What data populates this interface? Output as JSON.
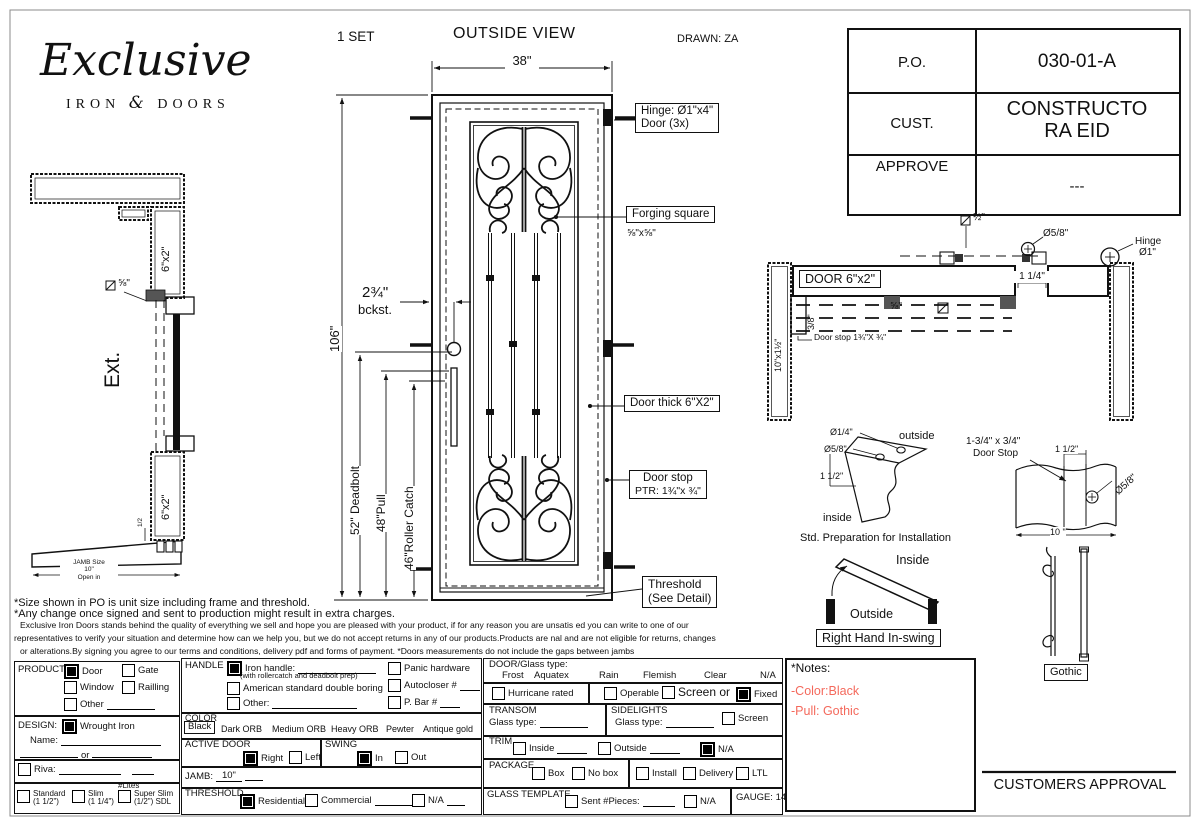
{
  "page": {
    "set": "1  SET",
    "view_title": "OUTSIDE VIEW",
    "drawn": "DRAWN: ZA"
  },
  "logo": {
    "script": "Exclusive",
    "word1": "IRON",
    "amp": "&",
    "word2": "DOORS"
  },
  "po_table": {
    "po_label": "P.O.",
    "po_value": "030-01-A",
    "cust_label": "CUST.",
    "cust_value": "CONSTRUCTO RA EID",
    "approve_label": "APPROVE",
    "approve_value": "---"
  },
  "elevation": {
    "dim_width": "38\"",
    "dim_height": "106\"",
    "dim_deadbolt": "52\" Deadbolt",
    "dim_pull": "48\"Pull",
    "dim_roller": "46\"Roller Catch",
    "backset1": "2¾\"",
    "backset2": "bckst.",
    "note_hinge1": "Hinge: Ø1\"x4\"",
    "note_hinge2": "Door (3x)",
    "note_forging": "Forging square",
    "note_forging_size": "⅝\"x⅝\"",
    "note_thick": "Door thick 6\"X2\"",
    "note_stop1": "Door stop",
    "note_stop2": "PTR: 1¾\"x ¾\"",
    "note_threshold1": "Threshold",
    "note_threshold2": "(See Detail)"
  },
  "left_section": {
    "ext": "Ext.",
    "tube_top": "6\"x2\"",
    "tube_bottom": "6\"x2\"",
    "dia_size": "⅝\"",
    "half": "1/2",
    "jamb1": "JAMB Size",
    "jamb2": "10\"",
    "jamb3": "Open in"
  },
  "plan": {
    "door": "DOOR 6\"x2\"",
    "jamb": "10\"x1½\"",
    "half_sq": "½\"",
    "dia58": "Ø5/8\"",
    "hinge1": "Hinge",
    "hinge2": "Ø1\"",
    "dim114": "1 1/4\"",
    "frac58": "⅝\"",
    "frac38": "3/8\"",
    "doorstop": "Door stop  1¾\"X ¾\""
  },
  "prep": {
    "d14": "Ø1/4\"",
    "d58": "Ø5/8\"",
    "d112": "1 1/2\"",
    "outside": "outside",
    "inside": "inside",
    "caption": "Std. Preparation for Installation"
  },
  "stop_detail": {
    "l1": "1-3/4\" x 3/4\"",
    "l2": "Door Stop",
    "d112": "1 1/2\"",
    "d58": "Ø5/8\"",
    "d10": "10 \""
  },
  "swing_detail": {
    "inside": "Inside",
    "outside": "Outside",
    "caption": "Right Hand In-swing"
  },
  "pull_detail": {
    "caption": "Gothic"
  },
  "disclaimer": {
    "l1": "*Size shown in PO is unit size including frame and threshold.",
    "l2": "*Any change once signed and sent to production might result in extra charges.",
    "l3": "Exclusive Iron Doors stands behind the quality of everything we sell and hope you are pleased with your product, if for any reason you are unsatis   ed you can write to one of our",
    "l4": "representatives to verify your situation and determine how can we help you, but we do not accept returns in any of our products.Products are    nal and are not eligible for returns, changes",
    "l5": "or alterations.By signing you agree to our terms and conditions, delivery pdf and forms of payment. *Doors measurements do not include the gaps between jambs"
  },
  "form": {
    "product": {
      "label": "PRODUCT:",
      "opt_door": "Door",
      "door_checked": true,
      "opt_gate": "Gate",
      "gate_checked": false,
      "opt_window": "Window",
      "window_checked": false,
      "opt_railling": "Railling",
      "railling_checked": false,
      "opt_other": "Other",
      "other_checked": false
    },
    "handle": {
      "label": "HANDLE",
      "iron": "Iron handle:",
      "iron_checked": true,
      "iron_note": "(with rollercatch and deadbolt prep)",
      "american": "American standard double boring",
      "american_checked": false,
      "other": "Other:",
      "other_checked": false,
      "panic": "Panic hardware",
      "panic_checked": false,
      "autocloser": "Autocloser #",
      "autocloser_checked": false,
      "pbar": "P. Bar #",
      "pbar_checked": false
    },
    "design": {
      "label": "DESIGN:",
      "wrought": "Wrought Iron",
      "wrought_checked": true,
      "name": "Name:",
      "or": "or"
    },
    "color": {
      "label": "COLOR",
      "selected": "Black",
      "opt2": "Dark ORB",
      "opt3": "Medium ORB",
      "opt4": "Heavy ORB",
      "opt5": "Pewter",
      "opt6": "Antique gold"
    },
    "active": {
      "label": "ACTIVE DOOR",
      "right": "Right",
      "right_checked": true,
      "left": "Left",
      "left_checked": false
    },
    "swing": {
      "label": "SWING",
      "in": "In",
      "in_checked": true,
      "out": "Out",
      "out_checked": false
    },
    "riva": {
      "label": "Riva:",
      "checked": false,
      "lites": "#Lites"
    },
    "grid": {
      "standard": "Standard",
      "standard_sub": "(1 1/2\")",
      "standard_checked": false,
      "slim": "Slim",
      "slim_sub": "(1 1/4\")",
      "slim_checked": false,
      "super": "Super Slim",
      "super_sub": "(1/2\") SDL",
      "super_checked": false
    },
    "jamb": {
      "label": "JAMB:",
      "value": "10\""
    },
    "threshold": {
      "label": "THRESHOLD",
      "residential": "Residential",
      "residential_checked": true,
      "commercial": "Commercial",
      "commercial_checked": false,
      "na": "N/A",
      "na_checked": false
    },
    "doorglass": {
      "label": "DOOR/Glass type:",
      "o1": "Frost",
      "o2": "Aquatex",
      "o3": "Rain",
      "o4": "Flemish",
      "o5": "Clear",
      "o6": "N/A"
    },
    "hurricane": {
      "label": "Hurricane rated",
      "checked": false
    },
    "screenrow": {
      "operable": "Operable",
      "operable_checked": false,
      "screen": "Screen or",
      "screen_checked": false,
      "fixed": "Fixed",
      "fixed_checked": true
    },
    "transom": {
      "label": "TRANSOM",
      "glass": "Glass type:"
    },
    "sidelights": {
      "label": "SIDELIGHTS",
      "glass": "Glass type:",
      "screen": "Screen",
      "screen_checked": false
    },
    "trim": {
      "label": "TRIM",
      "inside": "Inside",
      "inside_checked": false,
      "outside": "Outside",
      "outside_checked": false,
      "na": "N/A",
      "na_checked": true
    },
    "package": {
      "label": "PACKAGE",
      "box": "Box",
      "nobox": "No box",
      "install": "Install",
      "delivery": "Delivery",
      "ltl": "LTL"
    },
    "template": {
      "label": "GLASS TEMPLATE",
      "sent": "Sent #Pieces:",
      "sent_checked": false,
      "na": "N/A",
      "na_checked": false,
      "gauge": "GAUGE: 14"
    }
  },
  "notes": {
    "title": "*Notes:",
    "n1": "-Color:Black",
    "n2": "-Pull: Gothic",
    "color": "#f4695c"
  },
  "approval": {
    "label": "CUSTOMERS APPROVAL"
  }
}
